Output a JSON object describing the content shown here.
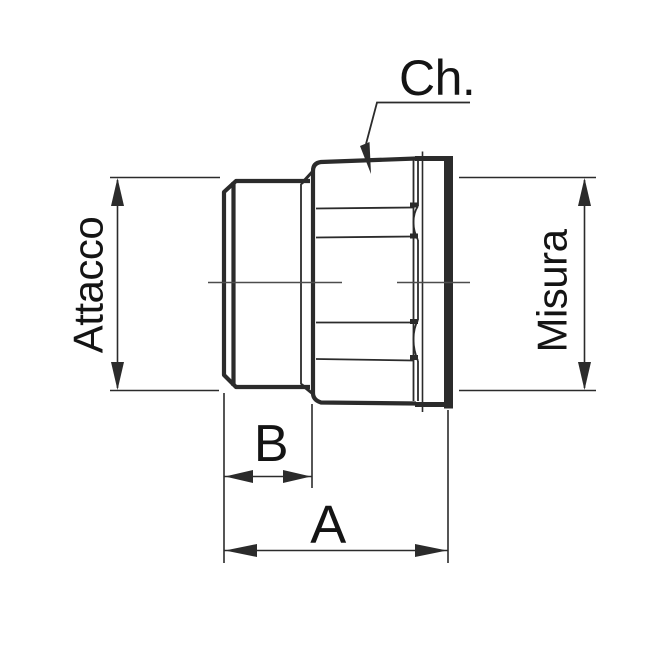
{
  "labels": {
    "chamfer": "Ch.",
    "attacco": "Attacco",
    "misura": "Misura",
    "thread_length": "B",
    "overall_length": "A"
  },
  "colors": {
    "background": "#ffffff",
    "line": "#2b2b2b",
    "text": "#141414"
  }
}
